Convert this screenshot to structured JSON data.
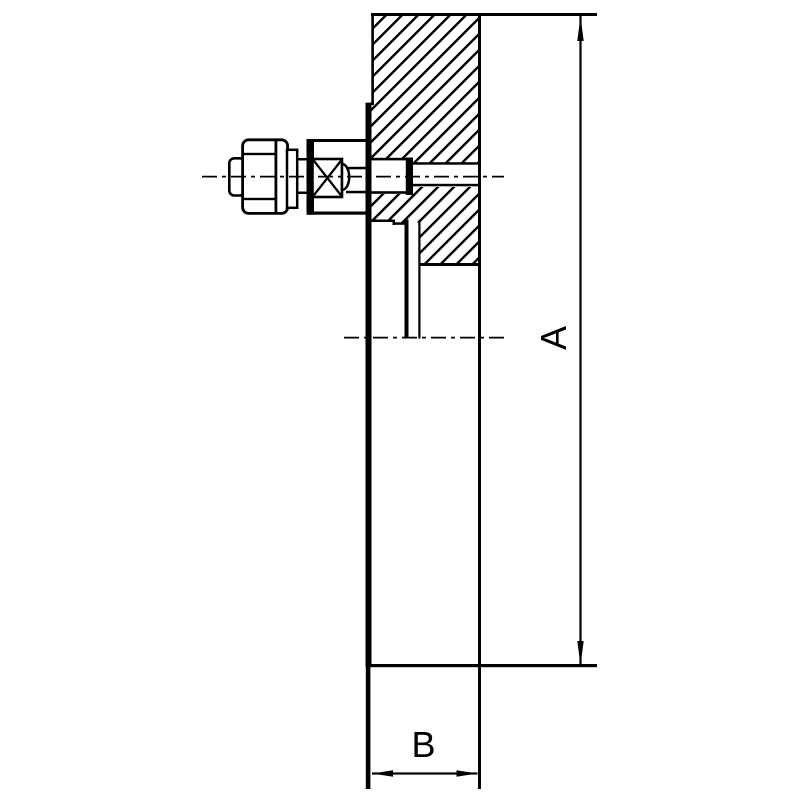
{
  "drawing": {
    "dimension_labels": {
      "a": "A",
      "b": "B"
    },
    "colors": {
      "line": "#000000",
      "background": "#ffffff"
    }
  }
}
